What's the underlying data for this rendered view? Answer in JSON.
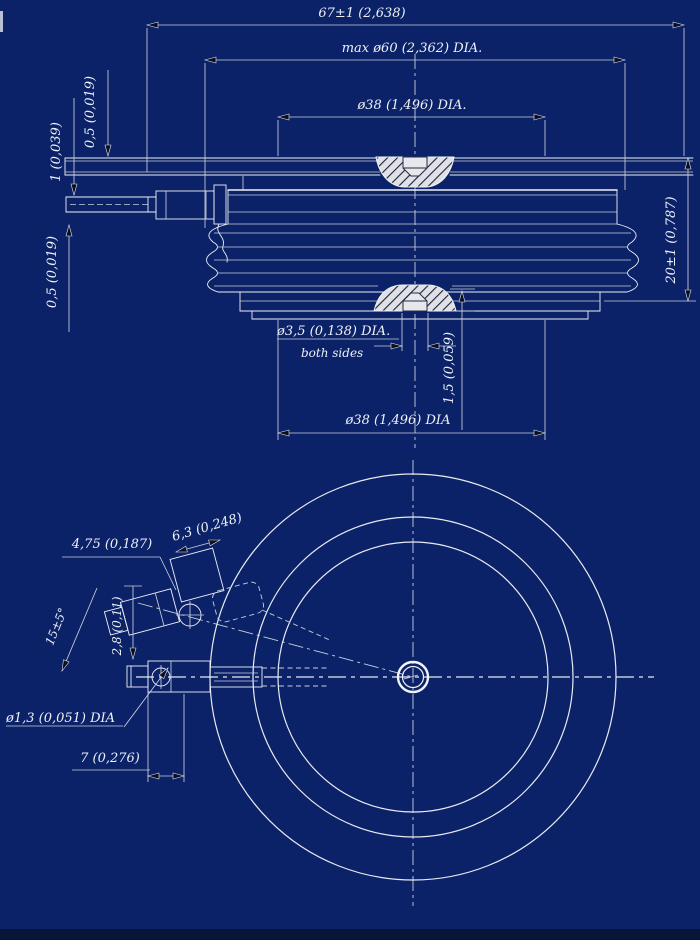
{
  "title": "disc-thyristor-outline-drawing",
  "colors": {
    "background": "#0b2268",
    "ink": "#eef1f6",
    "dim_lines": "#c9cedb",
    "hatch_fill": "#dfe1e6",
    "hatch_stroke": "#1c2036"
  },
  "side": {
    "overall_width": "67±1 (2,638)",
    "max_dia": "max ø60 (2,362) DIA.",
    "top_pole_dia": "ø38 (1,496) DIA.",
    "height": "20±1 (0,787)",
    "strip_top": "0,5 (0,019)",
    "tube": "1 (0,039)",
    "strip_bottom": "0,5 (0,019)",
    "center_hole": "ø3,5 (0,138) DIA.",
    "center_hole_note": "both sides",
    "recess_depth": "1,5 (0,059)",
    "bottom_pole_dia": "ø38 (1,496) DIA"
  },
  "plan": {
    "pad_width": "4,75 (0,187)",
    "pad_length": "6,3 (0,248)",
    "lead_angle": "15±5°",
    "lead_offset": "2,8 (0,11)",
    "hole_dia": "ø1,3 (0,051) DIA",
    "lead_length": "7 (0,276)"
  }
}
